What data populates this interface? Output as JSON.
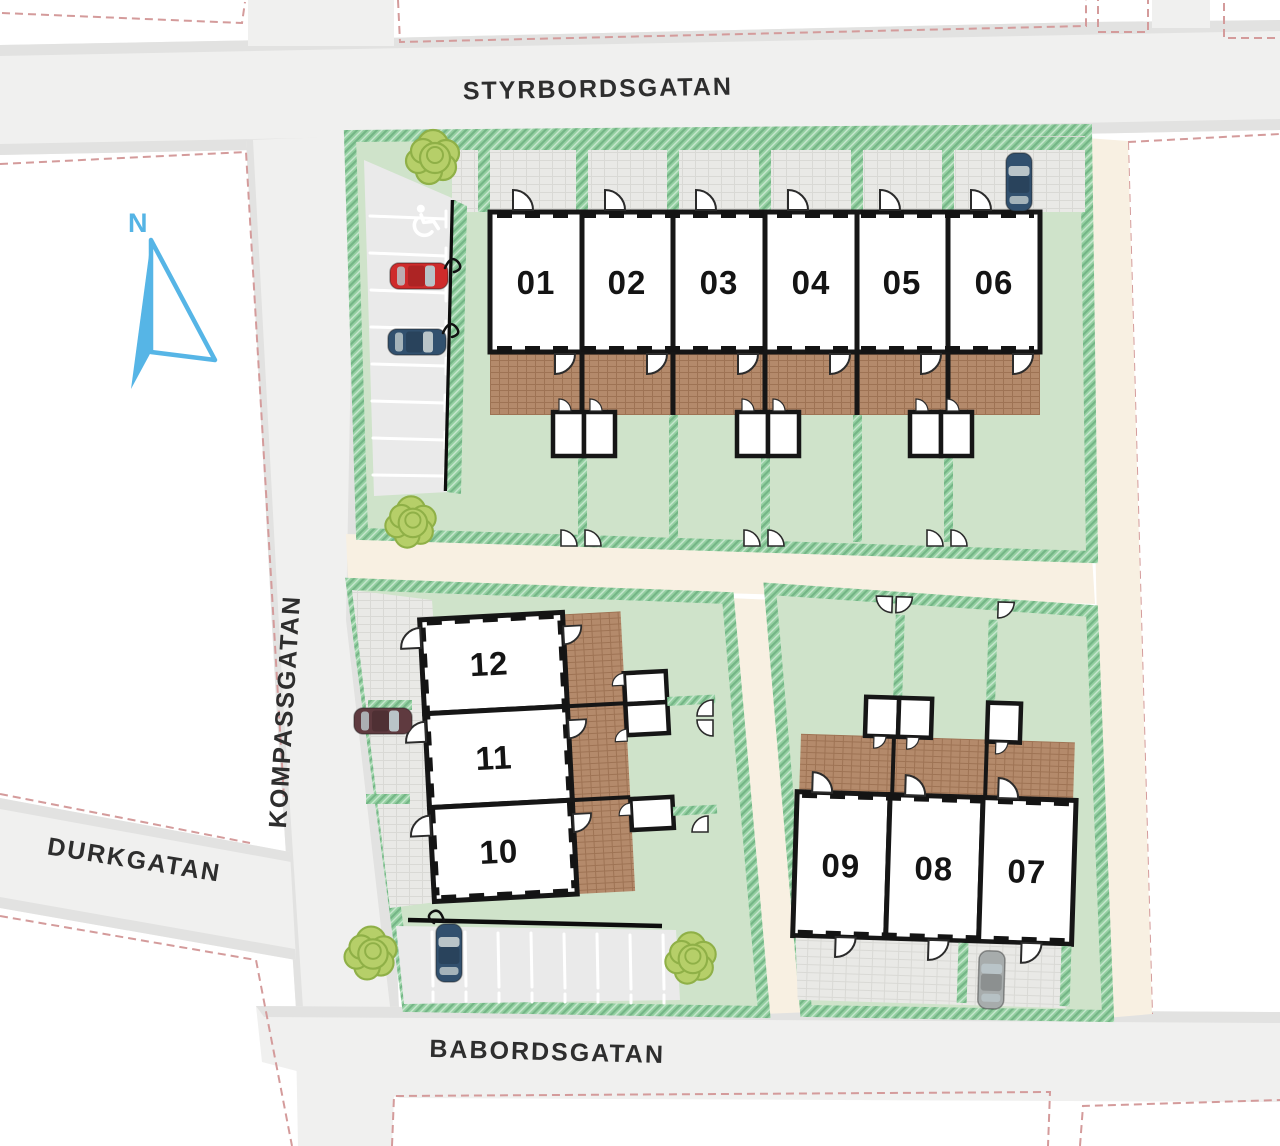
{
  "site_plan": {
    "streets": {
      "north": "STYRBORDSGATAN",
      "west": "KOMPASSGATAN",
      "southwest": "DURKGATAN",
      "south": "BABORDSGATAN"
    },
    "compass": {
      "label": "N",
      "color": "#56b5e6"
    },
    "houses": [
      {
        "number": "01"
      },
      {
        "number": "02"
      },
      {
        "number": "03"
      },
      {
        "number": "04"
      },
      {
        "number": "05"
      },
      {
        "number": "06"
      },
      {
        "number": "07"
      },
      {
        "number": "08"
      },
      {
        "number": "09"
      },
      {
        "number": "10"
      },
      {
        "number": "11"
      },
      {
        "number": "12"
      }
    ],
    "parking": {
      "west_lot": {
        "spaces": 8,
        "accessible_space": true,
        "ev_charging": true
      },
      "south_lot": {
        "spaces": 8,
        "ev_charging": true
      }
    },
    "cars": [
      {
        "color": "#cf2b2b",
        "location": "west-parking",
        "charging": true
      },
      {
        "color": "#31506e",
        "location": "west-parking",
        "charging": true
      },
      {
        "color": "#31506e",
        "location": "house-06-driveway",
        "charging": false
      },
      {
        "color": "#5f3a3f",
        "location": "house-11-driveway",
        "charging": false
      },
      {
        "color": "#31506e",
        "location": "south-parking",
        "charging": true
      },
      {
        "color": "#a7acac",
        "location": "house-07-driveway",
        "charging": false
      }
    ],
    "trees": 4,
    "colors": {
      "street": "#f0f0ef",
      "path": "#f8f0e2",
      "lawn": "#cfe3ca",
      "hedge": "#93cfa0",
      "deck": "#b48a6b",
      "plot_boundary": "#d49b9b",
      "house_fill": "#ffffff",
      "wall": "#161616",
      "north_arrow": "#56b5e6"
    },
    "icons": [
      "north-arrow-icon",
      "accessible-parking-icon",
      "tree-icon",
      "ev-cable-icon",
      "door-swing-icon"
    ]
  }
}
